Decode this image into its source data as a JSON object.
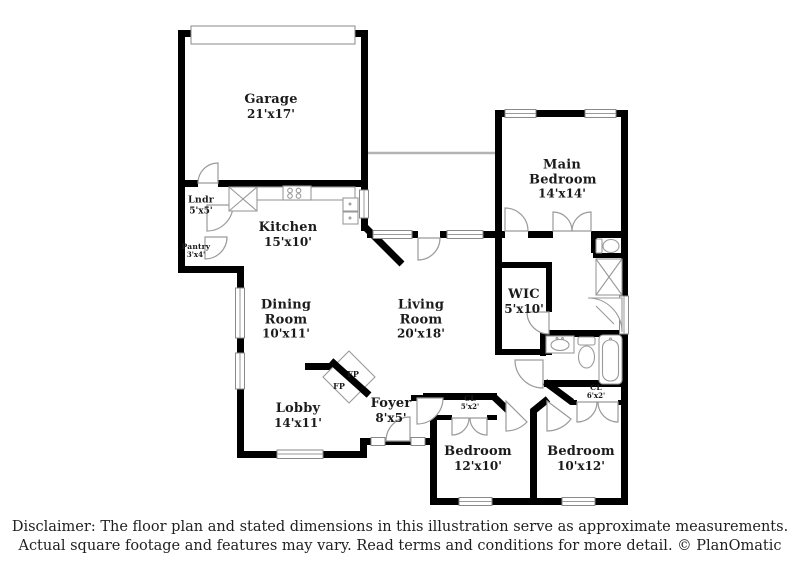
{
  "plan_title": "Floor plan",
  "colors": {
    "wall": "#000000",
    "fixture": "#9a9a9a",
    "text": "#1b1b1b"
  },
  "rooms": [
    {
      "id": "garage",
      "name": "Garage",
      "dims": "21'x17'"
    },
    {
      "id": "laundry",
      "name": "Lndr",
      "dims": "5'x5'"
    },
    {
      "id": "kitchen",
      "name": "Kitchen",
      "dims": "15'x10'"
    },
    {
      "id": "pantry",
      "name": "Pantry",
      "dims": "3'x4'"
    },
    {
      "id": "dining-room",
      "name": "Dining Room",
      "dims": "10'x11'"
    },
    {
      "id": "living-room",
      "name": "Living Room",
      "dims": "20'x18'"
    },
    {
      "id": "main-bedroom",
      "name": "Main Bedroom",
      "dims": "14'x14'"
    },
    {
      "id": "wic",
      "name": "WIC",
      "dims": "5'x10'"
    },
    {
      "id": "lobby",
      "name": "Lobby",
      "dims": "14'x11'"
    },
    {
      "id": "foyer",
      "name": "Foyer",
      "dims": "8'x5'"
    },
    {
      "id": "bedroom-1",
      "name": "Bedroom",
      "dims": "12'x10'"
    },
    {
      "id": "bedroom-2",
      "name": "Bedroom",
      "dims": "10'x12'"
    },
    {
      "id": "closet-1",
      "name": "CL",
      "dims": "5'x2'"
    },
    {
      "id": "closet-2",
      "name": "CL",
      "dims": "6'x2'"
    }
  ],
  "fireplace_label": "FP",
  "disclaimer": {
    "line1": "Disclaimer: The floor plan and stated dimensions in this illustration serve as approximate measurements.",
    "line2": "Actual square footage and features may vary. Read terms and conditions for more detail. © PlanOmatic"
  }
}
